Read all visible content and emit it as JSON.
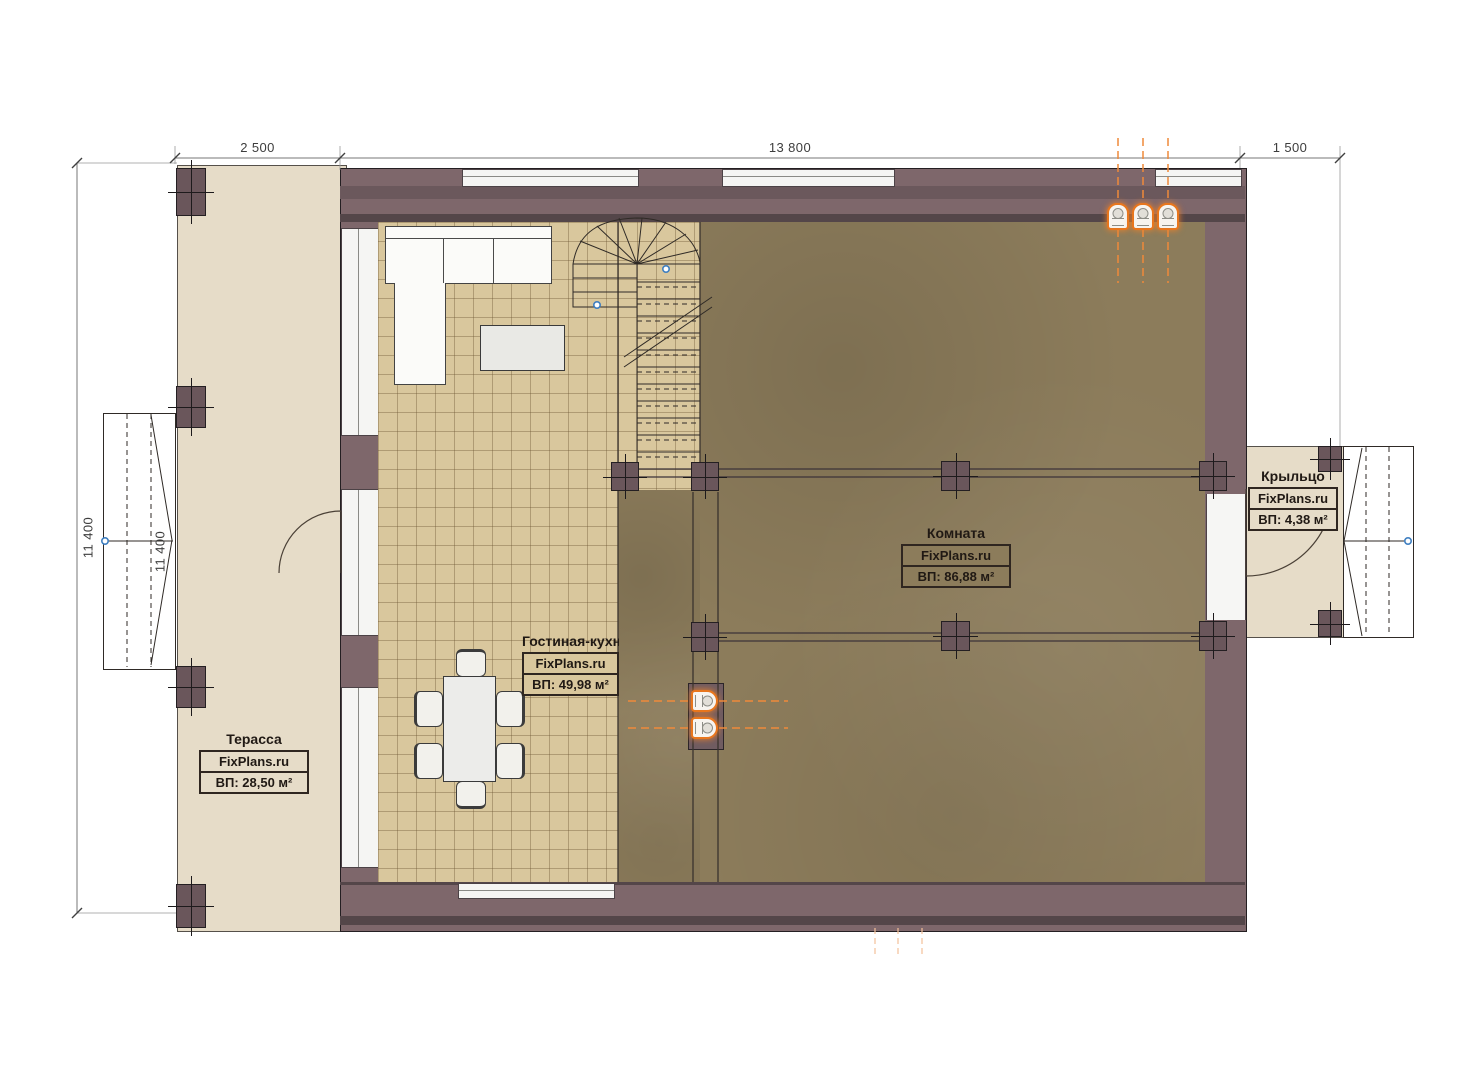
{
  "plan": {
    "dimensions": {
      "top_left": "2 500",
      "top_center": "13 800",
      "top_right": "1 500",
      "left_outer": "11 400",
      "left_inner": "11 400"
    },
    "rooms": {
      "terrace": {
        "name": "Терасса",
        "brand": "FixPlans.ru",
        "area": "ВП: 28,50 м²"
      },
      "living_kitchen": {
        "name": "Гостиная-кухня",
        "brand": "FixPlans.ru",
        "area": "ВП: 49,98 м²"
      },
      "room": {
        "name": "Комната",
        "brand": "FixPlans.ru",
        "area": "ВП: 86,88 м²"
      },
      "porch": {
        "name": "Крыльцо",
        "brand": "FixPlans.ru",
        "area": "ВП: 4,38 м²"
      }
    },
    "colors": {
      "wall": "#7e676b",
      "wall_dark": "#544649",
      "terrace_floor": "#e6dcc8",
      "tile_floor": "#d9c79d",
      "room_floor": "#8c7c5b",
      "plumbing_accent": "#e8761d",
      "node_blue": "#3f7fc1"
    }
  }
}
